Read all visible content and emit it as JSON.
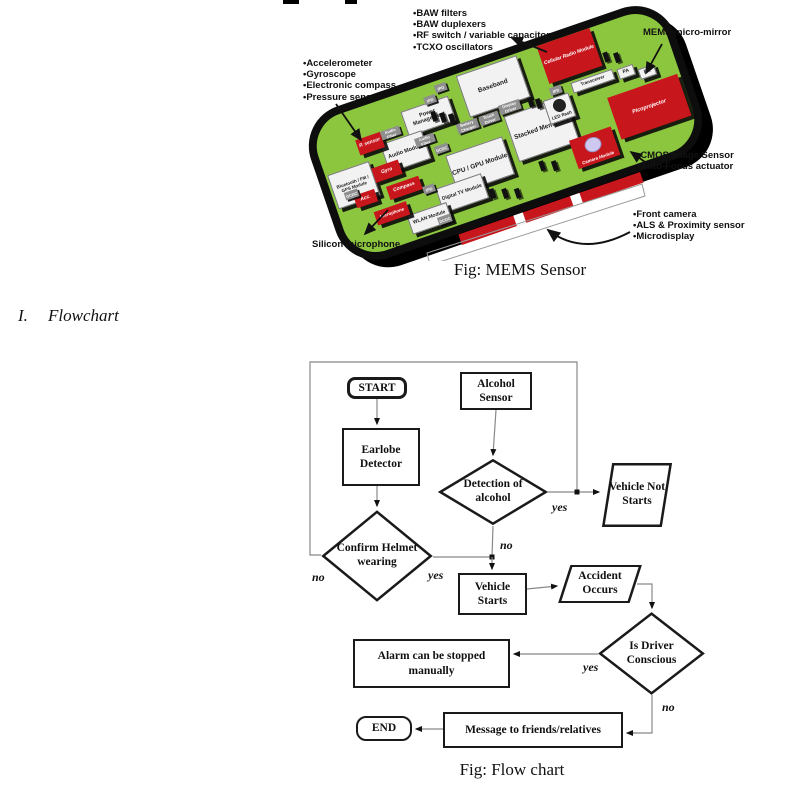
{
  "mems": {
    "caption": "Fig: MEMS Sensor",
    "callouts": {
      "top_list": [
        "•BAW filters",
        "•BAW duplexers",
        "•RF switch / variable capacitor",
        "•TCXO oscillators"
      ],
      "micro_mirror": "MEMS micro-mirror",
      "left_list": [
        "•Accelerometer",
        "•Gyroscope",
        "•Electronic compass",
        "•Pressure sensor"
      ],
      "cmos_list": [
        "•CMOS Image Sensor",
        "•Auto-Focus actuator"
      ],
      "front_list": [
        "•Front camera",
        "•ALS & Proximity sensor",
        "•Microdisplay"
      ],
      "silicon_mic": "Silicon microphone"
    },
    "board": {
      "baseband": "Baseband",
      "cellular": "Cellular Radio Module",
      "transceiver": "Transceiver",
      "pa1": "PA",
      "pa2": "PA",
      "picoprojector": "Picoprojector",
      "led_flash": "LED flash",
      "camera": "Camera Module",
      "stacked": "Stacked Memories",
      "cpu_gpu": "CPU / GPU Module",
      "power_mgmt": "Power Management",
      "audio_module": "Audio Module",
      "digital_tv": "Digital TV Module",
      "wlan": "WLAN Module",
      "bluetooth": "Bluetooth / FM / GPS Module",
      "p_sensor": "P. sensor",
      "gyro": "Gyro",
      "acc": "Acc.",
      "compass": "Compass",
      "microphone": "Microphone"
    },
    "chips": [
      "IPD",
      "IPD",
      "IPD",
      "IPD",
      "DCDC",
      "DCDC",
      "DCDC",
      "Audio Filter",
      "Audio Filter",
      "Battery Charger",
      "Touch Driver",
      "Display Driver"
    ],
    "colors": {
      "board_green": "#8cc63e",
      "mems_red": "#c8161d",
      "bezel_black": "#0d0d0d",
      "chip_gray": "#8f8f8f"
    }
  },
  "section": {
    "numeral": "I.",
    "title": "Flowchart"
  },
  "flowchart": {
    "caption": "Fig: Flow chart",
    "nodes": {
      "start": "START",
      "alcohol_sensor": "Alcohol Sensor",
      "earlobe_detector": "Earlobe Detector",
      "detection": "Detection of alcohol",
      "vehicle_not_starts": "Vehicle Not Starts",
      "confirm_helmet": "Confirm Helmet wearing",
      "vehicle_starts": "Vehicle Starts",
      "accident_occurs": "Accident Occurs",
      "is_driver_conscious": "Is Driver Conscious",
      "alarm": "Alarm can be stopped manually",
      "message": "Message to friends/relatives",
      "end": "END"
    },
    "edge_labels": {
      "detection_yes": "yes",
      "detection_no": "no",
      "helmet_no": "no",
      "helmet_yes": "yes",
      "conscious_yes": "yes",
      "conscious_no": "no"
    }
  }
}
